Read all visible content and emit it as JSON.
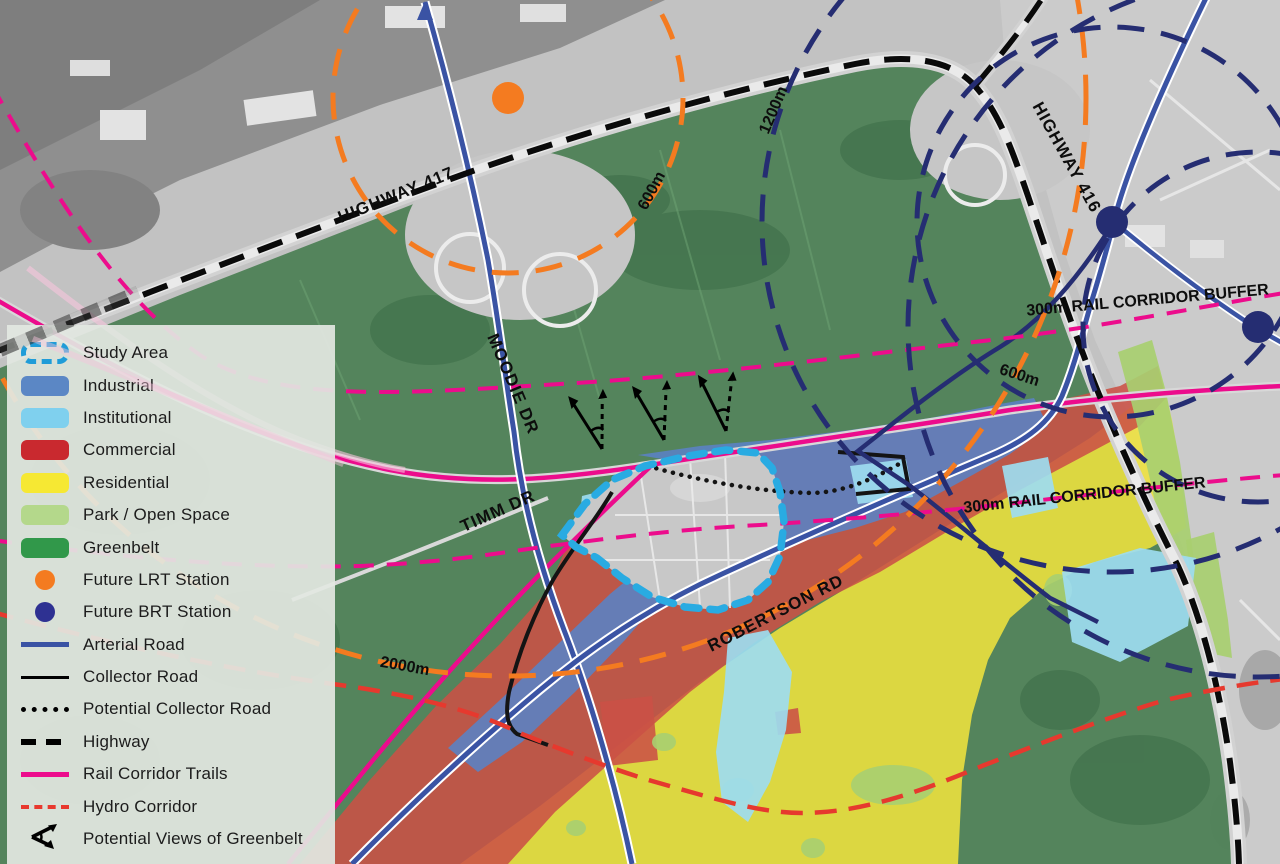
{
  "legend": {
    "items": [
      {
        "label": "Study Area",
        "type": "dashed-outline",
        "color": "#1f9cd8"
      },
      {
        "label": "Industrial",
        "type": "fill",
        "color": "#5b87c5"
      },
      {
        "label": "Institutional",
        "type": "fill",
        "color": "#7fd0ee"
      },
      {
        "label": "Commercial",
        "type": "fill",
        "color": "#c9292f"
      },
      {
        "label": "Residential",
        "type": "fill",
        "color": "#f6e833"
      },
      {
        "label": "Park / Open Space",
        "type": "fill",
        "color": "#b4d88b"
      },
      {
        "label": "Greenbelt",
        "type": "fill",
        "color": "#31984a"
      },
      {
        "label": "Future LRT Station",
        "type": "dot",
        "color": "#f47b20"
      },
      {
        "label": "Future BRT Station",
        "type": "dot",
        "color": "#2e3192"
      },
      {
        "label": "Arterial Road",
        "type": "line",
        "color": "#3a53a4"
      },
      {
        "label": "Collector Road",
        "type": "thin-line",
        "color": "#000000"
      },
      {
        "label": "Potential Collector Road",
        "type": "dotted-line",
        "color": "#000000"
      },
      {
        "label": "Highway",
        "type": "dashed-line-thick",
        "color": "#000000"
      },
      {
        "label": "Rail Corridor Trails",
        "type": "line",
        "color": "#ec0c8c"
      },
      {
        "label": "Hydro Corridor",
        "type": "dashed-line",
        "color": "#e8392e"
      },
      {
        "label": "Potential Views of Greenbelt",
        "type": "view-arrows",
        "color": "#000000"
      }
    ]
  },
  "map": {
    "labels": {
      "highway417": "HIGHWAY 417",
      "highway416": "HIGHWAY 416",
      "moodie_dr": "MOODIE DR",
      "timm_dr": "TIMM DR",
      "robertson_rd": "ROBERTSON RD",
      "rail_buffer_north": "300m RAIL CORRIDOR BUFFER",
      "rail_buffer_south": "300m RAIL CORRIDOR BUFFER",
      "lrt_ring_600": "600m",
      "lrt_ring_2000": "2000m",
      "brt_ring_600": "600m",
      "brt_ring_1200": "1200m"
    },
    "stations": {
      "lrt": [
        {
          "x": 508,
          "y": 98
        }
      ],
      "brt": [
        {
          "x": 1112,
          "y": 222
        },
        {
          "x": 1258,
          "y": 327
        }
      ]
    },
    "colors": {
      "study_area": "#29abe2",
      "industrial": "#5b82c2",
      "institutional": "#9ddcf0",
      "commercial": "#cb5146",
      "residential": "#efe23e",
      "park": "#a8cf70",
      "greenbelt": "#4b7f54",
      "lrt_station": "#f47b20",
      "brt_station": "#252d72",
      "arterial": "#3a53a4",
      "collector": "#141414",
      "highway": "#0a0a0a",
      "rail": "#ec0c8c",
      "hydro": "#e6392e"
    }
  }
}
